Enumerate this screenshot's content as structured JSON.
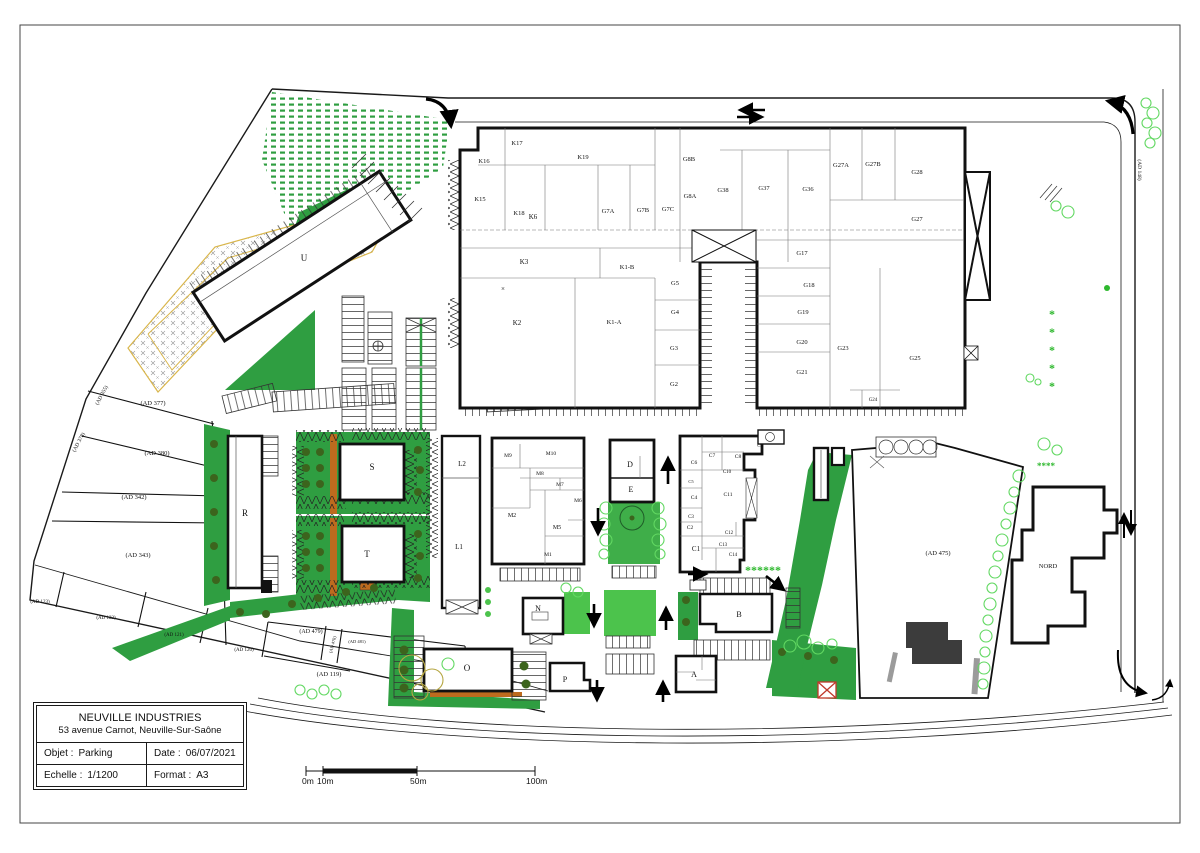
{
  "title_block": {
    "company": "NEUVILLE INDUSTRIES",
    "address": "53 avenue Carnot, Neuville-Sur-Saône",
    "objet_label": "Objet :",
    "objet_value": "Parking",
    "date_label": "Date :",
    "date_value": "06/07/2021",
    "echelle_label": "Echelle :",
    "echelle_value": "1/1200",
    "format_label": "Format :",
    "format_value": "A3"
  },
  "scale_bar": {
    "ticks": [
      "0m",
      "10m",
      "50m",
      "100m"
    ]
  },
  "colors": {
    "green_main": "#2f9e41",
    "green_bright": "#4cc34c",
    "tree": "#3c641d",
    "hedge": "#62d862",
    "orange": "#bd6b1e",
    "yellow": "#d9b64c",
    "dark_building": "#3c3c3c",
    "red": "#c0392b"
  },
  "plan": {
    "labels": [
      {
        "t": "K17",
        "x": 517,
        "y": 145,
        "k": "room"
      },
      {
        "t": "K16",
        "x": 484,
        "y": 163,
        "k": "room"
      },
      {
        "t": "K19",
        "x": 583,
        "y": 159,
        "k": "room"
      },
      {
        "t": "K15",
        "x": 480,
        "y": 201,
        "k": "room"
      },
      {
        "t": "K18",
        "x": 519,
        "y": 215,
        "k": "room"
      },
      {
        "t": "K6",
        "x": 533,
        "y": 219,
        "s": 7,
        "k": "room"
      },
      {
        "t": "G7A",
        "x": 608,
        "y": 213,
        "k": "room"
      },
      {
        "t": "G7B",
        "x": 643,
        "y": 212,
        "k": "room"
      },
      {
        "t": "G7C",
        "x": 668,
        "y": 211,
        "k": "room"
      },
      {
        "t": "G8B",
        "x": 689,
        "y": 161,
        "k": "room"
      },
      {
        "t": "G8A",
        "x": 690,
        "y": 198,
        "k": "room"
      },
      {
        "t": "G38",
        "x": 723,
        "y": 192,
        "k": "room"
      },
      {
        "t": "G37",
        "x": 764,
        "y": 190,
        "k": "room"
      },
      {
        "t": "G36",
        "x": 808,
        "y": 191,
        "k": "room"
      },
      {
        "t": "G27A",
        "x": 841,
        "y": 167,
        "k": "room"
      },
      {
        "t": "G27B",
        "x": 873,
        "y": 166,
        "k": "room"
      },
      {
        "t": "G28",
        "x": 917,
        "y": 174,
        "k": "room"
      },
      {
        "t": "G27",
        "x": 917,
        "y": 221,
        "k": "room"
      },
      {
        "t": "K3",
        "x": 524,
        "y": 264,
        "s": 7,
        "k": "room"
      },
      {
        "t": "K1-B",
        "x": 627,
        "y": 269,
        "k": "room"
      },
      {
        "t": "K2",
        "x": 517,
        "y": 325,
        "s": 7,
        "k": "room"
      },
      {
        "t": "K1-A",
        "x": 614,
        "y": 324,
        "k": "room"
      },
      {
        "t": "×",
        "x": 503,
        "y": 291,
        "s": 7,
        "k": "room"
      },
      {
        "t": "G5",
        "x": 675,
        "y": 285,
        "k": "room"
      },
      {
        "t": "G4",
        "x": 675,
        "y": 314,
        "k": "room"
      },
      {
        "t": "G3",
        "x": 674,
        "y": 350,
        "k": "room"
      },
      {
        "t": "G2",
        "x": 674,
        "y": 386,
        "k": "room"
      },
      {
        "t": "G17",
        "x": 802,
        "y": 255,
        "k": "room"
      },
      {
        "t": "G18",
        "x": 809,
        "y": 287,
        "k": "room"
      },
      {
        "t": "G19",
        "x": 803,
        "y": 314,
        "k": "room"
      },
      {
        "t": "G20",
        "x": 802,
        "y": 344,
        "k": "room"
      },
      {
        "t": "G21",
        "x": 802,
        "y": 374,
        "k": "room"
      },
      {
        "t": "G23",
        "x": 843,
        "y": 350,
        "k": "room"
      },
      {
        "t": "G25",
        "x": 915,
        "y": 360,
        "k": "room"
      },
      {
        "t": "G24",
        "x": 873,
        "y": 401,
        "s": 5,
        "k": "room"
      },
      {
        "t": "L2",
        "x": 462,
        "y": 466,
        "s": 7,
        "k": "room"
      },
      {
        "t": "L1",
        "x": 459,
        "y": 549,
        "s": 7,
        "k": "room"
      },
      {
        "t": "M9",
        "x": 508,
        "y": 457,
        "s": 5.5,
        "k": "room"
      },
      {
        "t": "M10",
        "x": 551,
        "y": 455,
        "s": 5.5,
        "k": "room"
      },
      {
        "t": "M8",
        "x": 540,
        "y": 475,
        "s": 5.5,
        "k": "room"
      },
      {
        "t": "M7",
        "x": 560,
        "y": 486,
        "s": 5.5,
        "k": "room"
      },
      {
        "t": "M6",
        "x": 578,
        "y": 502,
        "s": 5.5,
        "k": "room"
      },
      {
        "t": "M2",
        "x": 512,
        "y": 517,
        "s": 6,
        "k": "room"
      },
      {
        "t": "M5",
        "x": 557,
        "y": 529,
        "s": 6,
        "k": "room"
      },
      {
        "t": "M1",
        "x": 548,
        "y": 556,
        "s": 5.5,
        "k": "room"
      },
      {
        "t": "D",
        "x": 630,
        "y": 467,
        "s": 8,
        "k": "bldg"
      },
      {
        "t": "E",
        "x": 631,
        "y": 492,
        "s": 8,
        "k": "bldg"
      },
      {
        "t": "C6",
        "x": 694,
        "y": 464,
        "s": 5.5,
        "k": "room"
      },
      {
        "t": "C7",
        "x": 712,
        "y": 457,
        "s": 5.5,
        "k": "room"
      },
      {
        "t": "C8",
        "x": 738,
        "y": 458,
        "s": 5.5,
        "k": "room"
      },
      {
        "t": "C9",
        "x": 760,
        "y": 447,
        "s": 4.5,
        "k": "room"
      },
      {
        "t": "C10",
        "x": 727,
        "y": 473,
        "s": 5,
        "k": "room"
      },
      {
        "t": "C5",
        "x": 691,
        "y": 483,
        "s": 4.5,
        "k": "room"
      },
      {
        "t": "C4",
        "x": 694,
        "y": 499,
        "s": 5.5,
        "k": "room"
      },
      {
        "t": "C11",
        "x": 728,
        "y": 496,
        "s": 5.5,
        "k": "room"
      },
      {
        "t": "C3",
        "x": 691,
        "y": 518,
        "s": 5,
        "k": "room"
      },
      {
        "t": "C2",
        "x": 690,
        "y": 529,
        "s": 5.5,
        "k": "room"
      },
      {
        "t": "C12",
        "x": 729,
        "y": 534,
        "s": 5,
        "k": "room"
      },
      {
        "t": "C13",
        "x": 723,
        "y": 546,
        "s": 5,
        "k": "room"
      },
      {
        "t": "C1",
        "x": 696,
        "y": 551,
        "s": 7,
        "k": "room"
      },
      {
        "t": "C14",
        "x": 733,
        "y": 556,
        "s": 5,
        "k": "room"
      },
      {
        "t": "U",
        "x": 304,
        "y": 261,
        "s": 9,
        "k": "bldg"
      },
      {
        "t": "R",
        "x": 245,
        "y": 516,
        "s": 9,
        "k": "bldg"
      },
      {
        "t": "S",
        "x": 372,
        "y": 470,
        "s": 9,
        "k": "bldg"
      },
      {
        "t": "T",
        "x": 367,
        "y": 557,
        "s": 9,
        "k": "bldg"
      },
      {
        "t": "O",
        "x": 467,
        "y": 671,
        "s": 9,
        "k": "bldg"
      },
      {
        "t": "N",
        "x": 538,
        "y": 611,
        "s": 8,
        "k": "bldg"
      },
      {
        "t": "P",
        "x": 565,
        "y": 682,
        "s": 8,
        "k": "bldg"
      },
      {
        "t": "A",
        "x": 694,
        "y": 677,
        "s": 8,
        "k": "bldg"
      },
      {
        "t": "B",
        "x": 739,
        "y": 617,
        "s": 8,
        "k": "bldg"
      },
      {
        "t": "NORD",
        "x": 1048,
        "y": 568,
        "s": 6.5,
        "k": "bldg"
      },
      {
        "t": "(AD 377)",
        "x": 153,
        "y": 405,
        "s": 6.5,
        "k": "parcel"
      },
      {
        "t": "(AD 380)",
        "x": 157,
        "y": 455,
        "s": 6.5,
        "k": "parcel"
      },
      {
        "t": "(AD 342)",
        "x": 134,
        "y": 499,
        "s": 6.5,
        "k": "parcel"
      },
      {
        "t": "(AD 343)",
        "x": 138,
        "y": 557,
        "s": 6.5,
        "k": "parcel"
      },
      {
        "t": "(AD 355)",
        "x": 103,
        "y": 396,
        "s": 5.5,
        "r": -62,
        "k": "parcel"
      },
      {
        "t": "(AD 378)",
        "x": 80,
        "y": 443,
        "s": 5.5,
        "r": -62,
        "k": "parcel"
      },
      {
        "t": "(AD 123)",
        "x": 40,
        "y": 603,
        "s": 5,
        "k": "parcel"
      },
      {
        "t": "(AD 122)",
        "x": 106,
        "y": 619,
        "s": 5,
        "k": "parcel"
      },
      {
        "t": "(AD 121)",
        "x": 174,
        "y": 636,
        "s": 5,
        "k": "parcel"
      },
      {
        "t": "(AD 120)",
        "x": 244,
        "y": 651,
        "s": 5,
        "k": "parcel"
      },
      {
        "t": "(AD 479)",
        "x": 311,
        "y": 633,
        "s": 6,
        "k": "parcel"
      },
      {
        "t": "(AD 478)",
        "x": 334,
        "y": 645,
        "s": 4.5,
        "r": -75,
        "k": "parcel"
      },
      {
        "t": "(AD 481)",
        "x": 357,
        "y": 643,
        "s": 4.5,
        "k": "parcel"
      },
      {
        "t": "(AD 119)",
        "x": 329,
        "y": 676,
        "s": 6.5,
        "k": "parcel"
      },
      {
        "t": "(AD 475)",
        "x": 938,
        "y": 555,
        "s": 6.5,
        "k": "parcel"
      },
      {
        "t": "(AD 148)",
        "x": 1138,
        "y": 170,
        "s": 5.5,
        "r": 90,
        "k": "parcel"
      },
      {
        "t": "******",
        "x": 763,
        "y": 574,
        "s": 12,
        "c": "#2eb82e",
        "k": "star"
      },
      {
        "t": "****",
        "x": 1046,
        "y": 469,
        "s": 9,
        "c": "#2eb82e",
        "k": "star"
      },
      {
        "t": "*",
        "x": 1052,
        "y": 318,
        "s": 12,
        "c": "#2eb82e",
        "k": "star"
      },
      {
        "t": "*",
        "x": 1052,
        "y": 336,
        "s": 12,
        "c": "#2eb82e",
        "k": "star"
      },
      {
        "t": "*",
        "x": 1052,
        "y": 354,
        "s": 12,
        "c": "#2eb82e",
        "k": "star"
      },
      {
        "t": "*",
        "x": 1052,
        "y": 372,
        "s": 12,
        "c": "#2eb82e",
        "k": "star"
      },
      {
        "t": "*",
        "x": 1052,
        "y": 390,
        "s": 12,
        "c": "#2eb82e",
        "k": "star"
      }
    ]
  }
}
